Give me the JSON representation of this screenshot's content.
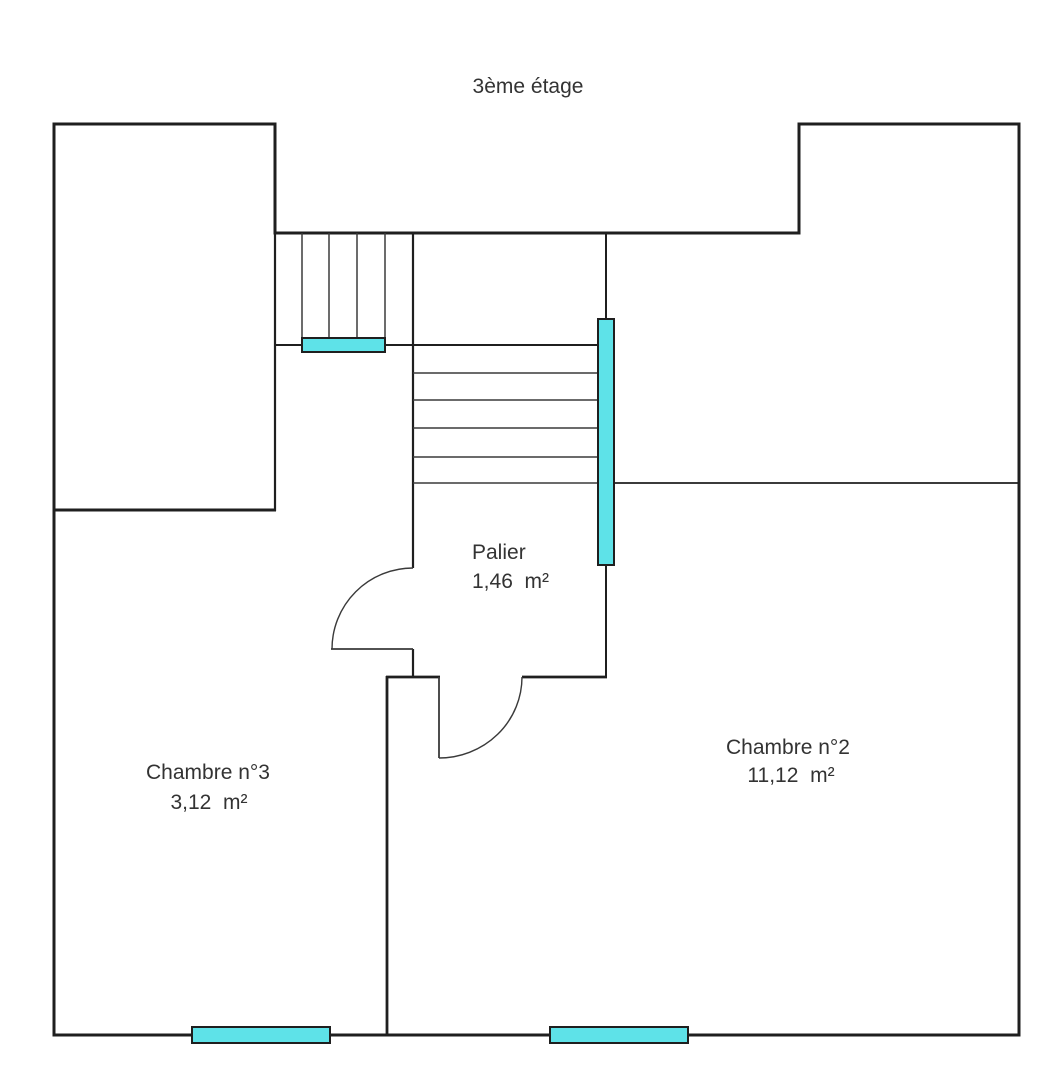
{
  "title": "3ème étage",
  "floor_plan": {
    "rooms": [
      {
        "name": "Palier",
        "area": "1,46  m²"
      },
      {
        "name": "Chambre n°2",
        "area": "11,12  m²"
      },
      {
        "name": "Chambre n°3",
        "area": "3,12  m²"
      }
    ],
    "stairs": {
      "upper_flight_treads": 4,
      "lower_flight_treads": 4
    },
    "windows": [
      {
        "id": "stair-upper-window"
      },
      {
        "id": "palier-east-window"
      },
      {
        "id": "chambre3-south-window"
      },
      {
        "id": "chambre2-south-window"
      }
    ],
    "colors": {
      "wall": "#1f1f1f",
      "line": "#3a3a3a",
      "window_fill": "#5ee2e8",
      "text": "#333333",
      "background": "#ffffff"
    }
  }
}
